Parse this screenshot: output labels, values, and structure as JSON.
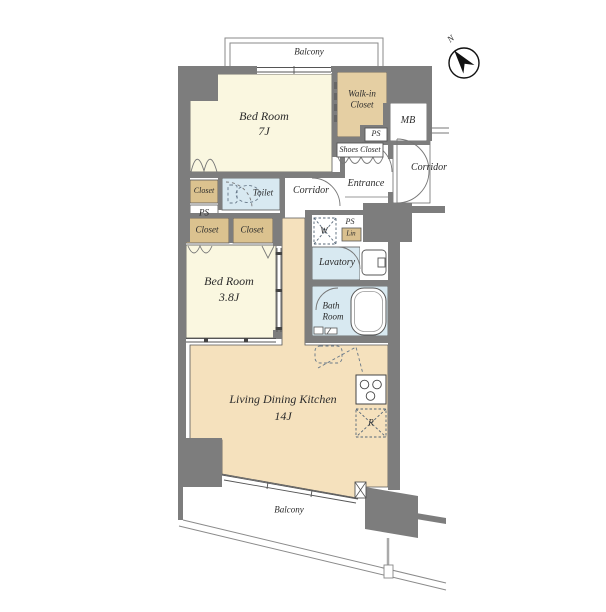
{
  "plan": {
    "type": "apartment-floor-plan",
    "labels": {
      "balcony_top": "Balcony",
      "balcony_bottom": "Balcony",
      "bedroom1_name": "Bed Room",
      "bedroom1_size": "7J",
      "bedroom2_name": "Bed Room",
      "bedroom2_size": "3.8J",
      "ldk_name": "Living Dining Kitchen",
      "ldk_size": "14J",
      "walkin_line1": "Walk-in",
      "walkin_line2": "Closet",
      "shoes_closet": "Shoes Closet",
      "entrance": "Entrance",
      "corridor_inner": "Corridor",
      "corridor_outer": "Corridor",
      "toilet": "Toilet",
      "closet_upper": "Closet",
      "closet_left": "Closet",
      "closet_right": "Closet",
      "ps_left": "PS",
      "ps_walkin": "PS",
      "ps_lavatory": "PS",
      "linen": "Lin",
      "washer": "W",
      "lavatory": "Lavatory",
      "bath_line1": "Bath",
      "bath_line2": "Room",
      "fridge": "R",
      "mb": "MB",
      "compass_north": "N"
    },
    "colors": {
      "wall": "#7d7d7d",
      "bedroom_floor": "#faf7e0",
      "ldk_floor": "#f5e1bd",
      "closet_fill": "#dbc28f",
      "walkin_fill": "#e5cfa3",
      "wet_area_fill": "#d8e9f1",
      "outline": "#565656"
    }
  }
}
